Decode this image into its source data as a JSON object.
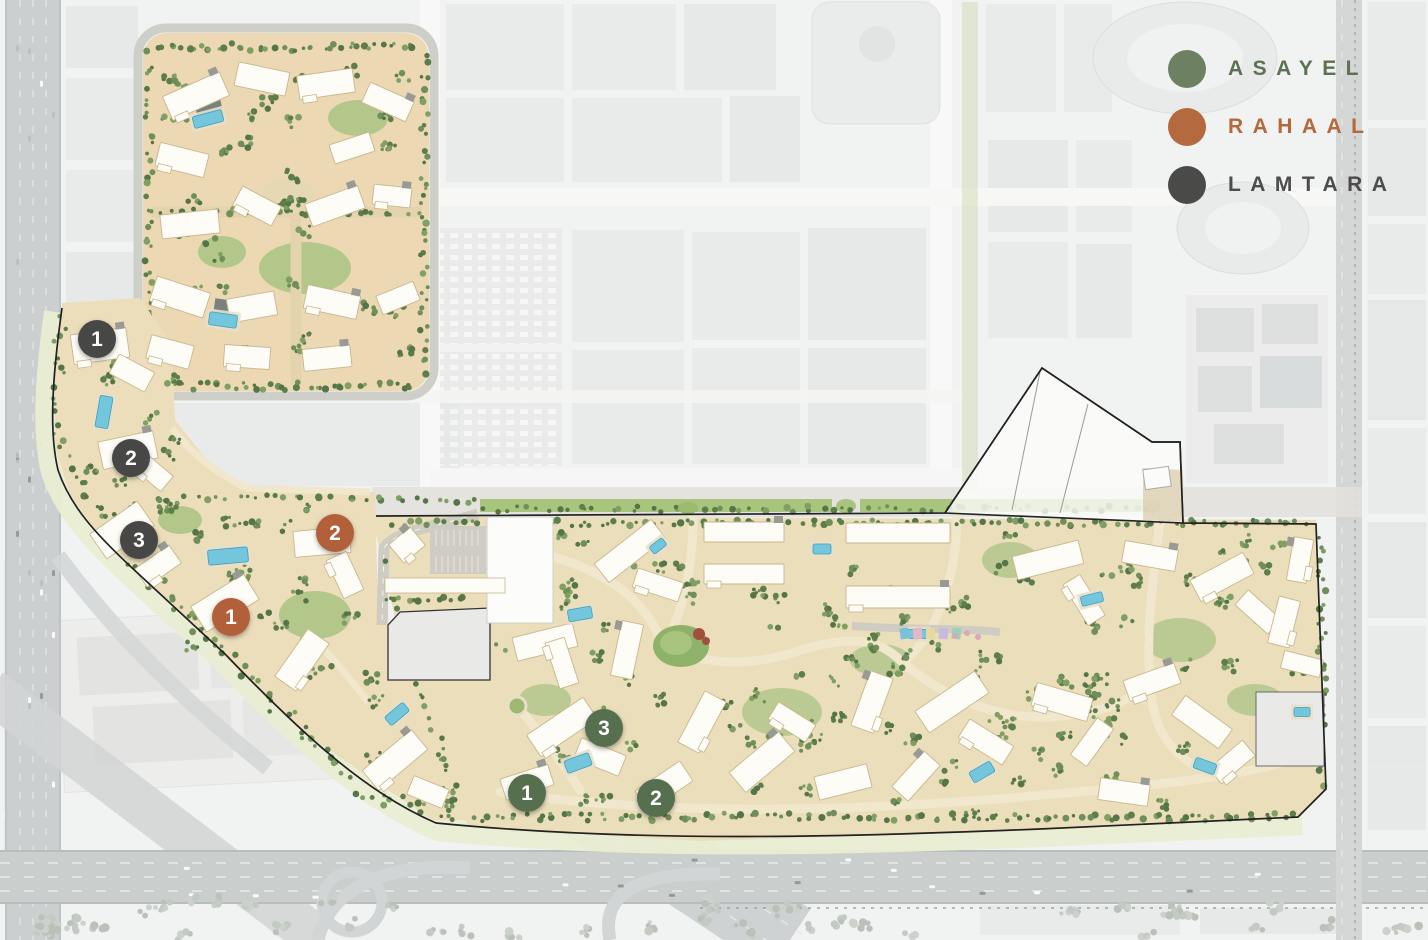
{
  "legend": {
    "items": [
      {
        "id": "asayel",
        "label": "ASAYEL",
        "color": "#6d8162",
        "text_color": "#5d7254"
      },
      {
        "id": "rahaal",
        "label": "RAHAAL",
        "color": "#b4693e",
        "text_color": "#b5683a"
      },
      {
        "id": "lamtara",
        "label": "LAMTARA",
        "color": "#4a4a49",
        "text_color": "#4c4c4a"
      }
    ]
  },
  "markers": [
    {
      "community": "lamtara",
      "label": "1",
      "x": 97,
      "y": 339,
      "color": "#474746"
    },
    {
      "community": "lamtara",
      "label": "2",
      "x": 131,
      "y": 458,
      "color": "#474746"
    },
    {
      "community": "lamtara",
      "label": "3",
      "x": 139,
      "y": 540,
      "color": "#474746"
    },
    {
      "community": "rahaal",
      "label": "2",
      "x": 335,
      "y": 533,
      "color": "#b2603a"
    },
    {
      "community": "rahaal",
      "label": "1",
      "x": 231,
      "y": 617,
      "color": "#b2603a"
    },
    {
      "community": "asayel",
      "label": "3",
      "x": 604,
      "y": 728,
      "color": "#56704f"
    },
    {
      "community": "asayel",
      "label": "1",
      "x": 527,
      "y": 793,
      "color": "#56704f"
    },
    {
      "community": "asayel",
      "label": "2",
      "x": 656,
      "y": 798,
      "color": "#56704f"
    }
  ],
  "map": {
    "site_colors": {
      "ground": "#ecdebb",
      "green_median": "#a9c47c",
      "edge_band": "#e9edd2",
      "pool": "#74c6dd",
      "boundary": "#222222"
    }
  }
}
